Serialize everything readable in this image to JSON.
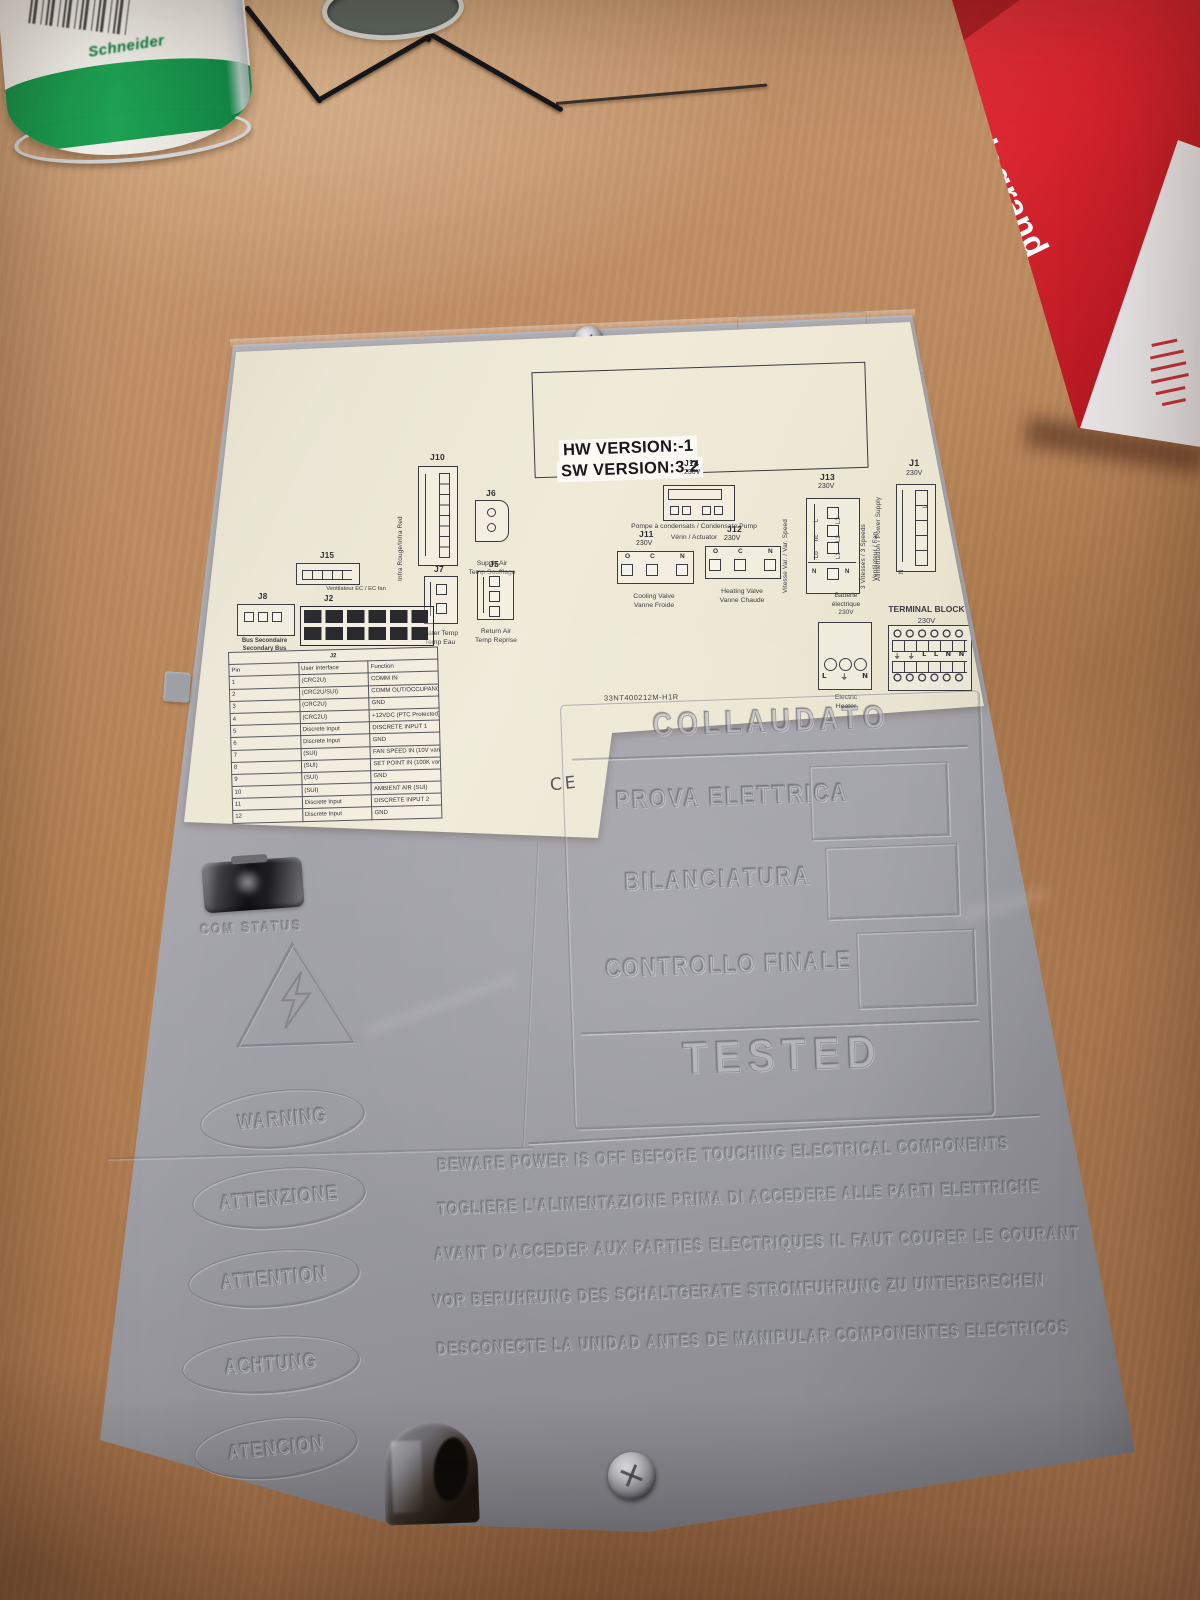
{
  "scene": {
    "props": {
      "schneider_brand": "Schneider",
      "legrand_brand": "legrand"
    }
  },
  "device": {
    "version_box": {
      "hw": "HW VERSION:-1",
      "sw": "SW VERSION:3.2"
    },
    "part_number": "33NT400212M-H1R",
    "ce_mark": "CE",
    "connectors": {
      "j10": {
        "name": "J10",
        "side_label": "Infra Rouge/Infra Red"
      },
      "j6": {
        "name": "J6",
        "cap1": "Supply Air",
        "cap2": "Temp Soufflage"
      },
      "j7": {
        "name": "J7",
        "cap1": "Water Temp",
        "cap2": "Temp Eau"
      },
      "j5": {
        "name": "J5",
        "cap1": "Return Air",
        "cap2": "Temp Reprise"
      },
      "j15": {
        "name": "J15",
        "cap1": "Ventilateur EC / EC fan"
      },
      "j8": {
        "name": "J8",
        "cap1": "Bus Secondaire",
        "cap2": "Secondary Bus"
      },
      "j2": {
        "name": "J2"
      },
      "j14": {
        "name": "J14",
        "volt": "230V",
        "cap1": "Pompe à condensats / Condensate Pump",
        "cap2": "Vérin / Actuator"
      },
      "j11": {
        "name": "J11",
        "volt": "230V",
        "pins": [
          "O",
          "C",
          "N"
        ],
        "cap1": "Cooling Valve",
        "cap2": "Vanne Froide"
      },
      "j12": {
        "name": "J12",
        "volt": "230V",
        "pins": [
          "O",
          "C",
          "N"
        ],
        "cap1": "Heating Valve",
        "cap2": "Vanne Chaude"
      },
      "j13": {
        "name": "J13",
        "volt": "230V",
        "left_label": "Vitesse Var. / Var. Speed",
        "pins_left": [
          "L",
          "nc",
          "Lo"
        ],
        "pin_bottom_left": "N",
        "pin_bottom_right": "N",
        "pins_right": [
          "L3",
          "L2",
          "L1"
        ],
        "right_label1": "3 Vitesses / 3 Speeds",
        "right_label2": "Ventilateur / Fan"
      },
      "heater": {
        "above1": "Batterie",
        "above2": "électrique",
        "above3": "230V",
        "pins": [
          "L",
          "⏚",
          "N"
        ],
        "below1": "Electric",
        "below2": "Heater"
      },
      "j1": {
        "name": "J1",
        "volt": "230V",
        "side_label": "Alimentation / Power Supply",
        "pin_top": "L",
        "pin_bottom": "N"
      },
      "terminal_block": {
        "title": "TERMINAL BLOCK",
        "volt": "230V",
        "labels": [
          "⏚",
          "⏚",
          "L",
          "L",
          "N",
          "N"
        ]
      }
    },
    "pin_table": {
      "title": "J2",
      "headers": [
        "Pin",
        "User Interface",
        "Function"
      ],
      "rows": [
        [
          "1",
          "(CRC2U)",
          "COMM IN"
        ],
        [
          "2",
          "(CRC2U/SUI)",
          "COMM OUT/OCCUPANCY LED"
        ],
        [
          "3",
          "(CRC2U)",
          "GND"
        ],
        [
          "4",
          "(CRC2U)",
          "+12VDC (PTC Protected)"
        ],
        [
          "5",
          "Discrete Input",
          "DISCRETE INPUT 1"
        ],
        [
          "6",
          "Discrete Input",
          "GND"
        ],
        [
          "7",
          "(SUI)",
          "FAN SPEED IN (10V variable)"
        ],
        [
          "8",
          "(SUI)",
          "SET POINT IN (100K variable)"
        ],
        [
          "9",
          "(SUI)",
          "GND"
        ],
        [
          "10",
          "(SUI)",
          "AMBIENT AIR (SUI)"
        ],
        [
          "11",
          "Discrete Input",
          "DISCRETE INPUT 2"
        ],
        [
          "12",
          "Discrete Input",
          "GND"
        ]
      ]
    },
    "molded": {
      "collaudato": "COLLAUDATO",
      "row1": "PROVA ELETTRICA",
      "row2": "BILANCIATURA",
      "row3": "CONTROLLO FINALE",
      "tested": "TESTED",
      "com_status": "COM STATUS",
      "ovals": [
        "WARNING",
        "ATTENZIONE",
        "ATTENTION",
        "ACHTUNG",
        "ATENCION"
      ],
      "warnings": [
        "BEWARE POWER IS OFF BEFORE TOUCHING ELECTRICAL COMPONENTS",
        "TOGLIERE L'ALIMENTAZIONE PRIMA DI ACCEDERE ALLE PARTI ELETTRICHE",
        "AVANT D'ACCEDER AUX PARTIES ELECTRIQUES IL FAUT COUPER LE COURANT",
        "VOR BERUHRUNG DES SCHALTGERATE STROMFUHRUNG ZU UNTERBRECHEN",
        "DESCONECTE LA UNIDAD ANTES DE MANIPULAR COMPONENTES ELECTRICOS"
      ]
    },
    "colors": {
      "legrand_red": "#d42430",
      "schneider_green": "#1f9e4d",
      "label_cream": "#ece7d5",
      "body_gray": "#a1a1a7"
    }
  }
}
